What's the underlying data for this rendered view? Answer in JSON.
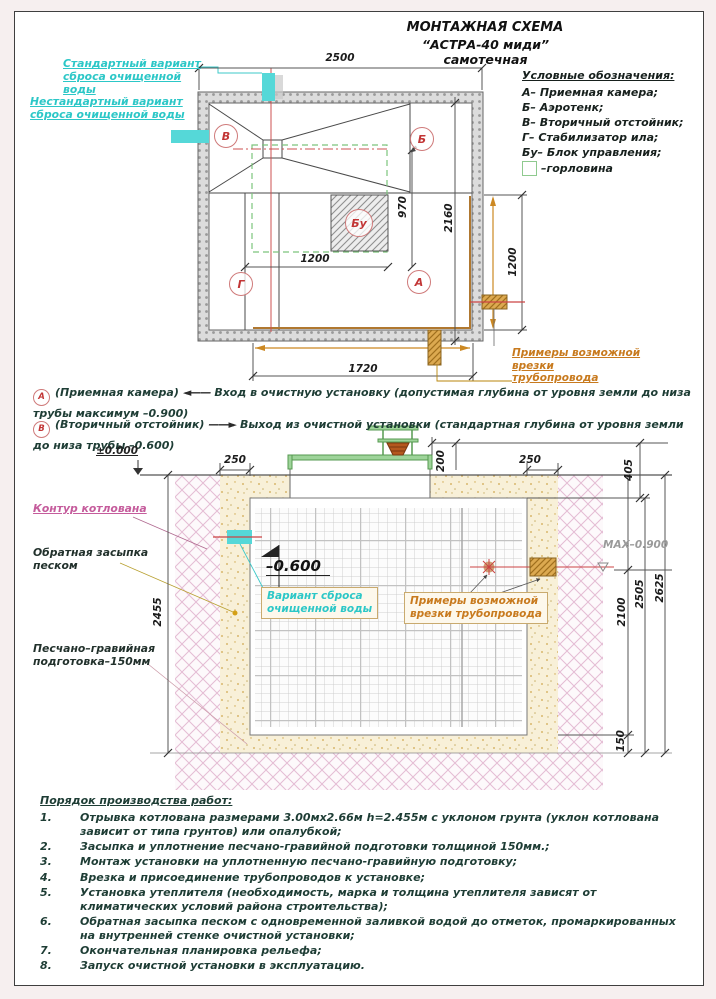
{
  "title": {
    "line1": "МОНТАЖНАЯ СХЕМА",
    "line2": "“АСТРА-40 миди” самотечная"
  },
  "legend": {
    "heading": "Условные обозначения:",
    "items": [
      "А– Приемная камера;",
      "Б– Аэротенк;",
      "В– Вторичный отстойник;",
      "Г– Стабилизатор ила;",
      "Бу– Блок управления;"
    ],
    "neck": "–горловина"
  },
  "plan": {
    "standard_outlet": "Стандартный вариант\nсброса очищенной воды",
    "nonstandard_outlet": "Нестандартный вариант\nсброса очищенной воды",
    "pipe_examples": "Примеры возможной врезки\nтрубопровода",
    "markers": {
      "a": "А",
      "b": "Б",
      "v": "В",
      "g": "Г",
      "bu": "Бу"
    },
    "dims": {
      "width": "2500",
      "chamber": "970",
      "depth": "2160",
      "control": "1200",
      "bottom": "1720",
      "inlet": "1200"
    }
  },
  "notes": {
    "a": {
      "marker": "А",
      "name": "(Приемная камера)",
      "text": "Вход в очистную установку (допустимая глубина от уровня земли до низа трубы максимум –0.900)"
    },
    "v": {
      "marker": "В",
      "name": "(Вторичный отстойник)",
      "text": "Выход из очистной установки (стандартная глубина от уровня земли до низа трубы –0.600)"
    }
  },
  "icons": {
    "arrow_left": "◄——",
    "arrow_right": "——►"
  },
  "section": {
    "levels": {
      "zero": "±0.000",
      "max": "MAX–0.900",
      "outlet": "–0.600"
    },
    "dims": {
      "left_gap": "250",
      "top_gap": "200",
      "right_gap": "250",
      "cover": "405",
      "pit_depth": "2455",
      "tank": "2100",
      "tank_total": "2505",
      "full": "2625",
      "bedding": "150"
    },
    "pit_contour": "Контур котлована",
    "backfill": "Обратная засыпка\nпеском",
    "bedding": "Песчано–гравийная\nподготовка–150мм",
    "outlet_variant": "Вариант сброса\nочищенной воды",
    "pipe_examples": "Примеры возможной\nврезки трубопровода"
  },
  "procedure": {
    "heading": "Порядок производства работ:",
    "items": [
      {
        "num": "1.",
        "text": "Отрывка котлована размерами 3.00мх2.66м h=2.455м с уклоном грунта (уклон котлована зависит от типа грунтов) или опалубкой;"
      },
      {
        "num": "2.",
        "text": "Засыпка и уплотнение песчано-гравийной подготовки толщиной 150мм.;"
      },
      {
        "num": "3.",
        "text": "Монтаж установки на уплотненную песчано-гравийную подготовку;"
      },
      {
        "num": "4.",
        "text": "Врезка и присоединение трубопроводов к установке;"
      },
      {
        "num": "5.",
        "text": "Установка утеплителя (необходимость, марка и толщина утеплителя зависят от климатических условий района строительства);"
      },
      {
        "num": "6.",
        "text": "Обратная засыпка песком с одновременной заливкой водой до отметок, промаркированных на внутренней стенке очистной установки;"
      },
      {
        "num": "7.",
        "text": "Окончательная планировка рельефа;"
      },
      {
        "num": "8.",
        "text": "Запуск очистной установки в эксплуатацию."
      }
    ]
  },
  "colors": {
    "cyan": "#2cc7c7",
    "orange": "#c87a1e",
    "magenta": "#c55c9c",
    "red_marker": "#c23535",
    "green": "#6fbf6f"
  }
}
